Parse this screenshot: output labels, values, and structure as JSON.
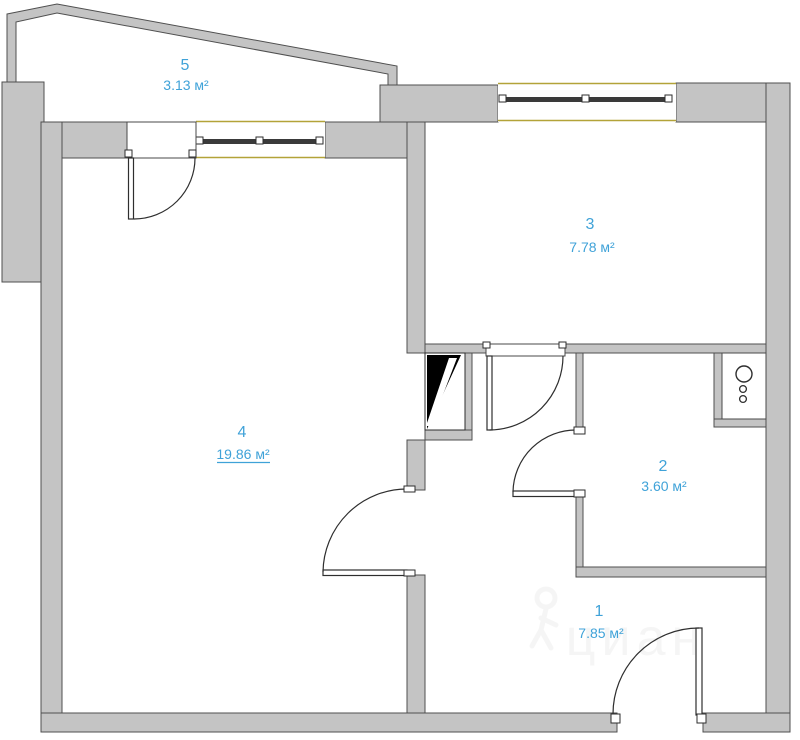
{
  "plan": {
    "type": "apartment-floor-plan",
    "rooms": {
      "r5": {
        "number": "5",
        "area": "3.13 м²"
      },
      "r3": {
        "number": "3",
        "area": "7.78 м²"
      },
      "r4": {
        "number": "4",
        "area": "19.86 м²"
      },
      "r2": {
        "number": "2",
        "area": "3.60 м²"
      },
      "r1": {
        "number": "1",
        "area": "7.85 м²"
      }
    },
    "watermark": {
      "text": "циан"
    },
    "icons": {
      "windows": "window-icon",
      "doors": "door-swing-icon",
      "vent": "vent-shaft-icon",
      "heater": "water-heater-icon",
      "watermark_logo": "person-pin-icon"
    },
    "colors": {
      "wall": "#c4c4c4",
      "wall_outline": "#4f4f4f",
      "label_blue": "#3fa2d8",
      "window_sill_yellow": "#b3a339",
      "vent_black": "#000000"
    }
  }
}
